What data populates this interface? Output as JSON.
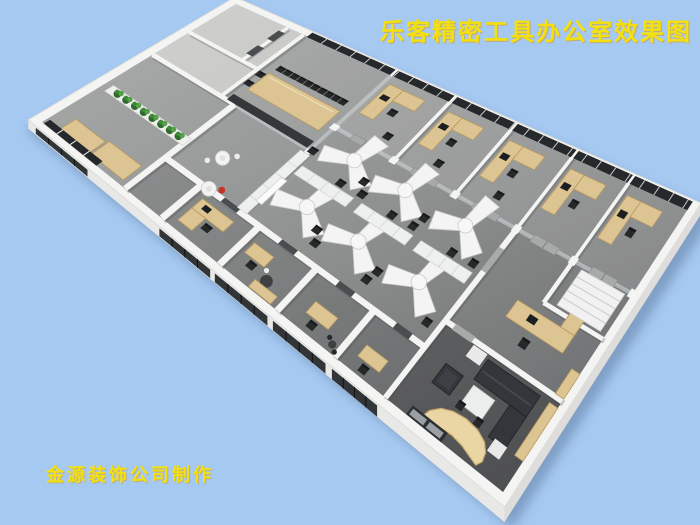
{
  "title": {
    "text": "乐客精密工具办公室效果图",
    "color": "#f4e00e"
  },
  "credit": {
    "text": "金源装饰公司制作",
    "color": "#f4e00e"
  },
  "colors": {
    "background": "#a6c9f1",
    "wall": "#f4f4f2",
    "wall_face": "#e8e8e6",
    "wall_face_dark": "#dedddb",
    "floor_far": "#a6a8a7",
    "floor_mid": "#8f9190",
    "floor_near": "#696b6d",
    "window_glass": "#26292c",
    "glass_partition": "rgba(204,212,215,0.6)",
    "wood": "#dcc493",
    "wood_edge": "#b99a60",
    "chair": "#26282a",
    "sofa": "#33363a",
    "plant_dark": "#2f6b2e",
    "plant_light": "#56a04a",
    "door_gray": "#a8aaa9",
    "door_dark": "#4a4d4f",
    "accent_red": "#c63226",
    "cabinet_white": "#eef0ef"
  },
  "scene": {
    "type": "3d-office-floorplan-render",
    "workstation_clusters": 6,
    "perimeter_window_offices": 5
  }
}
